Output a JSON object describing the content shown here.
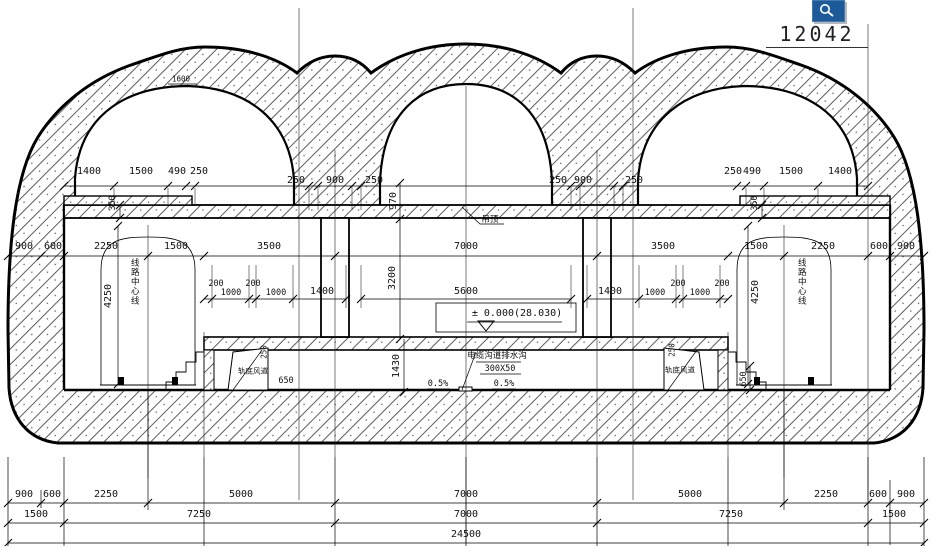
{
  "drawing_number": "12042",
  "toolbar": {
    "icon": "zoom-icon",
    "icon_color": "#1d5a9a"
  },
  "drawing": {
    "type": "tunnel-station-cross-section",
    "level_mark": "± 0.000(28.030)",
    "overall_width": "24500",
    "accent_black": "#111111"
  },
  "labels": [
    {
      "t": "1400",
      "x": 89,
      "y": 172,
      "n": "dim-top-left-1400"
    },
    {
      "t": "1500",
      "x": 141,
      "y": 172,
      "n": "dim-top-left-1500"
    },
    {
      "t": "490",
      "x": 177,
      "y": 172,
      "n": "dim-top-left-490"
    },
    {
      "t": "250",
      "x": 199,
      "y": 172,
      "n": "dim-top-left-250"
    },
    {
      "t": "250",
      "x": 733,
      "y": 172,
      "n": "dim-top-right-250"
    },
    {
      "t": "490",
      "x": 752,
      "y": 172,
      "n": "dim-top-right-490"
    },
    {
      "t": "1500",
      "x": 791,
      "y": 172,
      "n": "dim-top-right-1500"
    },
    {
      "t": "1400",
      "x": 840,
      "y": 172,
      "n": "dim-top-right-1400"
    },
    {
      "t": "250",
      "x": 296,
      "y": 181,
      "n": "dim-col-left-250a"
    },
    {
      "t": "900",
      "x": 335,
      "y": 181,
      "n": "dim-col-left-900"
    },
    {
      "t": "250",
      "x": 374,
      "y": 181,
      "n": "dim-col-left-250b"
    },
    {
      "t": "250",
      "x": 558,
      "y": 181,
      "n": "dim-col-right-250a"
    },
    {
      "t": "900",
      "x": 583,
      "y": 181,
      "n": "dim-col-right-900"
    },
    {
      "t": "250",
      "x": 634,
      "y": 181,
      "n": "dim-col-right-250b"
    },
    {
      "t": "900",
      "x": 24,
      "y": 247,
      "n": "dim-mid-900L"
    },
    {
      "t": "600",
      "x": 53,
      "y": 247,
      "n": "dim-mid-600L"
    },
    {
      "t": "2250",
      "x": 106,
      "y": 247,
      "n": "dim-mid-2250L"
    },
    {
      "t": "1500",
      "x": 176,
      "y": 247,
      "n": "dim-mid-1500L"
    },
    {
      "t": "3500",
      "x": 269,
      "y": 247,
      "n": "dim-mid-3500L"
    },
    {
      "t": "7000",
      "x": 466,
      "y": 247,
      "n": "dim-mid-7000"
    },
    {
      "t": "3500",
      "x": 663,
      "y": 247,
      "n": "dim-mid-3500R"
    },
    {
      "t": "1500",
      "x": 756,
      "y": 247,
      "n": "dim-mid-1500R"
    },
    {
      "t": "2250",
      "x": 823,
      "y": 247,
      "n": "dim-mid-2250R"
    },
    {
      "t": "600",
      "x": 879,
      "y": 247,
      "n": "dim-mid-600R"
    },
    {
      "t": "900",
      "x": 906,
      "y": 247,
      "n": "dim-mid-900R"
    },
    {
      "t": "200",
      "x": 216,
      "y": 284,
      "c": "s",
      "n": "dim-row-200a"
    },
    {
      "t": "1000",
      "x": 231,
      "y": 293,
      "c": "s",
      "n": "dim-row-1000a"
    },
    {
      "t": "200",
      "x": 253,
      "y": 284,
      "c": "s",
      "n": "dim-row-200b"
    },
    {
      "t": "1000",
      "x": 276,
      "y": 293,
      "c": "s",
      "n": "dim-row-1000b"
    },
    {
      "t": "1400",
      "x": 322,
      "y": 292,
      "n": "dim-row-1400L"
    },
    {
      "t": "5600",
      "x": 466,
      "y": 292,
      "n": "dim-row-5600"
    },
    {
      "t": "1400",
      "x": 610,
      "y": 292,
      "n": "dim-row-1400R"
    },
    {
      "t": "1000",
      "x": 655,
      "y": 293,
      "c": "s",
      "n": "dim-row-1000c"
    },
    {
      "t": "200",
      "x": 678,
      "y": 284,
      "c": "s",
      "n": "dim-row-200c"
    },
    {
      "t": "1000",
      "x": 700,
      "y": 293,
      "c": "s",
      "n": "dim-row-1000d"
    },
    {
      "t": "200",
      "x": 722,
      "y": 284,
      "c": "s",
      "n": "dim-row-200d"
    },
    {
      "t": "970",
      "x": 394,
      "y": 201,
      "c": "r",
      "n": "dim-vert-970"
    },
    {
      "t": "3200",
      "x": 393,
      "y": 278,
      "c": "r",
      "n": "dim-vert-3200"
    },
    {
      "t": "1430",
      "x": 397,
      "y": 366,
      "c": "r",
      "n": "dim-vert-1430"
    },
    {
      "t": "350",
      "x": 113,
      "y": 203,
      "c": "r s",
      "n": "dim-vert-350L"
    },
    {
      "t": "350",
      "x": 755,
      "y": 203,
      "c": "r s",
      "n": "dim-vert-350R"
    },
    {
      "t": "4250",
      "x": 109,
      "y": 296,
      "c": "r",
      "n": "dim-vert-4250L"
    },
    {
      "t": "4250",
      "x": 756,
      "y": 292,
      "c": "r",
      "n": "dim-vert-4250R"
    },
    {
      "t": "650",
      "x": 744,
      "y": 379,
      "c": "r s",
      "n": "dim-vert-650R"
    },
    {
      "t": "650",
      "x": 286,
      "y": 381,
      "c": "s",
      "n": "dim-650L"
    },
    {
      "t": "250",
      "x": 264,
      "y": 352,
      "c": "r xs",
      "n": "dim-small-250L"
    },
    {
      "t": "250",
      "x": 672,
      "y": 350,
      "c": "r xs",
      "n": "dim-small-250R"
    },
    {
      "t": "吊顶",
      "x": 490,
      "y": 220,
      "c": "s",
      "n": "label-suspended-ceiling"
    },
    {
      "t": "± 0.000(28.030)",
      "x": 517,
      "y": 314,
      "n": "label-level-mark"
    },
    {
      "t": "电缆沟道排水沟",
      "x": 497,
      "y": 356,
      "c": "s",
      "n": "label-cable-trench"
    },
    {
      "t": "300X50",
      "x": 500,
      "y": 369,
      "c": "s",
      "n": "label-trench-size"
    },
    {
      "t": "0.5%",
      "x": 438,
      "y": 384,
      "c": "s",
      "n": "label-slope-left"
    },
    {
      "t": "0.5%",
      "x": 504,
      "y": 384,
      "c": "s",
      "n": "label-slope-right"
    },
    {
      "t": "轨底风道",
      "x": 253,
      "y": 371,
      "c": "xs",
      "n": "label-underrail-duct-left"
    },
    {
      "t": "轨底风道",
      "x": 680,
      "y": 370,
      "c": "xs",
      "n": "label-underrail-duct-right"
    },
    {
      "t": "线路中心线",
      "x": 134,
      "y": 282,
      "c": "v",
      "n": "label-track-centerline-left"
    },
    {
      "t": "线路中心线",
      "x": 801,
      "y": 282,
      "c": "v",
      "n": "label-track-centerline-right"
    },
    {
      "t": "1600",
      "x": 181,
      "y": 79,
      "c": "xs",
      "n": "label-1600"
    },
    {
      "t": "900",
      "x": 24,
      "y": 495,
      "n": "dim-botA-900L"
    },
    {
      "t": "600",
      "x": 52,
      "y": 495,
      "n": "dim-botA-600L"
    },
    {
      "t": "2250",
      "x": 106,
      "y": 495,
      "n": "dim-botA-2250L"
    },
    {
      "t": "5000",
      "x": 241,
      "y": 495,
      "n": "dim-botA-5000L"
    },
    {
      "t": "7000",
      "x": 466,
      "y": 495,
      "n": "dim-botA-7000"
    },
    {
      "t": "5000",
      "x": 690,
      "y": 495,
      "n": "dim-botA-5000R"
    },
    {
      "t": "2250",
      "x": 826,
      "y": 495,
      "n": "dim-botA-2250R"
    },
    {
      "t": "600",
      "x": 878,
      "y": 495,
      "n": "dim-botA-600R"
    },
    {
      "t": "900",
      "x": 906,
      "y": 495,
      "n": "dim-botA-900R"
    },
    {
      "t": "1500",
      "x": 36,
      "y": 515,
      "n": "dim-botB-1500L"
    },
    {
      "t": "7250",
      "x": 199,
      "y": 515,
      "n": "dim-botB-7250L"
    },
    {
      "t": "7000",
      "x": 466,
      "y": 515,
      "n": "dim-botB-7000"
    },
    {
      "t": "7250",
      "x": 731,
      "y": 515,
      "n": "dim-botB-7250R"
    },
    {
      "t": "1500",
      "x": 894,
      "y": 515,
      "n": "dim-botB-1500R"
    },
    {
      "t": "24500",
      "x": 466,
      "y": 535,
      "n": "dim-botC-24500"
    }
  ]
}
